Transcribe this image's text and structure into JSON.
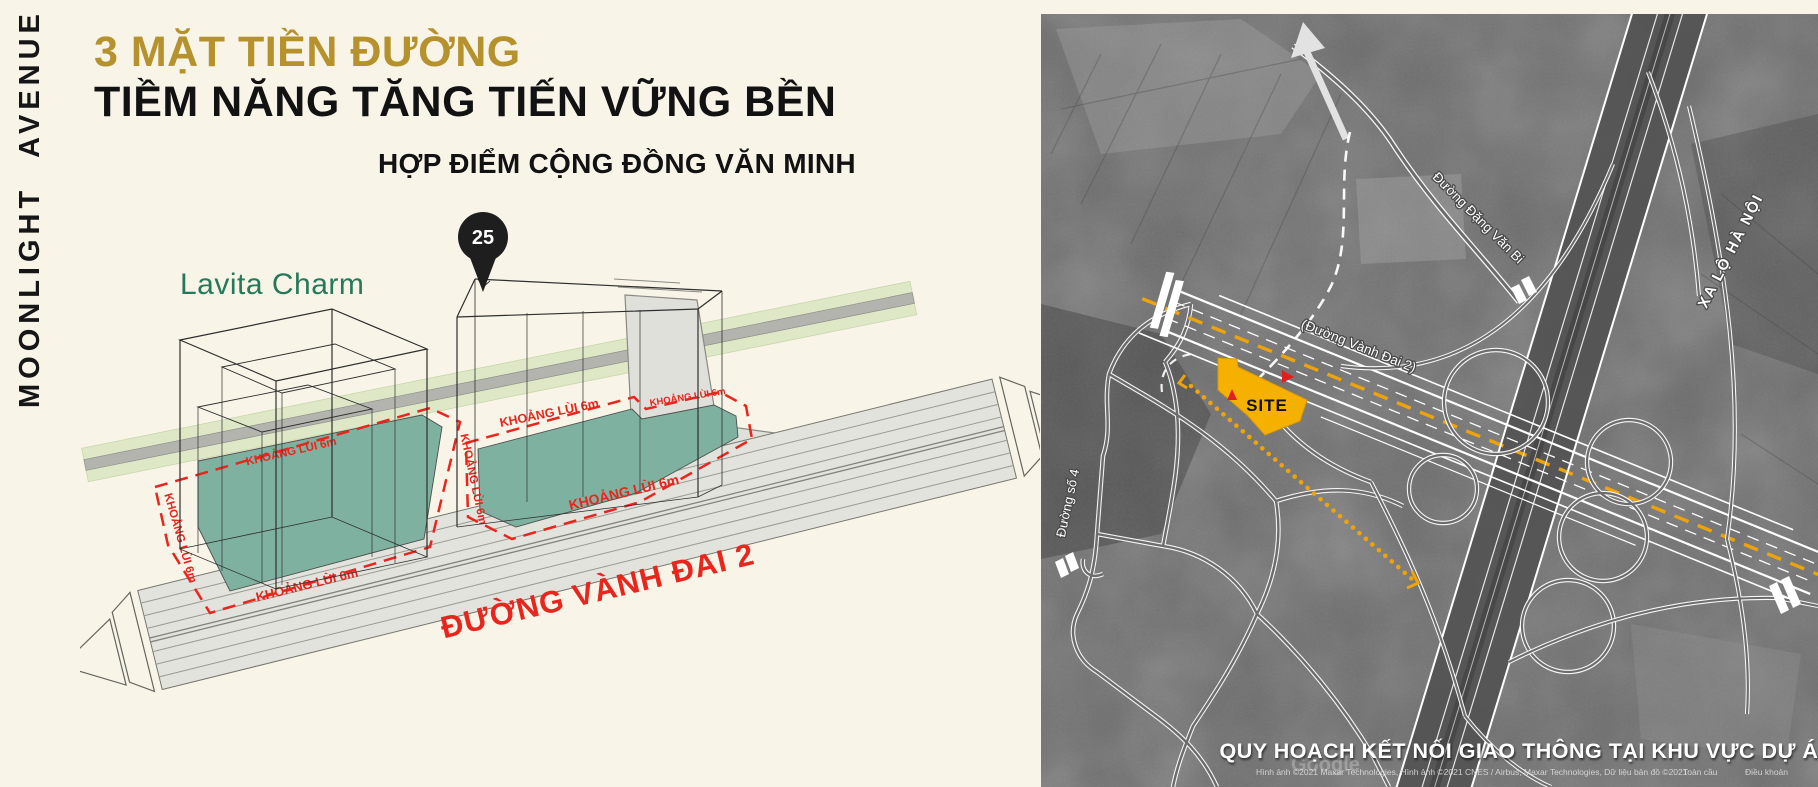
{
  "brand": {
    "vertical_title": "MOONLIGHT AVENUE"
  },
  "header": {
    "title_line1": "3 MẶT TIỀN ĐƯỜNG",
    "title_line2": "TIỀM NĂNG TĂNG TIẾN VỮNG BỀN",
    "subtitle": "HỢP ĐIỂM CỘNG ĐỒNG VĂN MINH"
  },
  "diagram": {
    "neighbor_label": "Lavita Charm",
    "pin_value": "25",
    "setback_label": "KHOẢNG LÙI 6m",
    "road_label": "ĐƯỜNG VÀNH ĐAI 2",
    "colors": {
      "setback_red": "#E8261D",
      "lot_teal": "#7FB1A0",
      "green_strip": "#DFE8C6",
      "road_gray": "#E3E3DE",
      "neighbor_green": "#26785A",
      "gold": "#B5922D"
    }
  },
  "map": {
    "site_label": "SITE",
    "labels": {
      "dang_van_bi": "Đường Đặng Văn Bi",
      "xa_lo_ha_noi": "XA LỘ HÀ NỘI",
      "vanh_dai_2": "(Đường Vành Đai 2)",
      "duong_so_4": "Đường số 4"
    },
    "caption": "QUY HOẠCH KẾT NỐI GIAO THÔNG TẠI KHU VỰC DỰ ÁN",
    "watermark": "Google",
    "attribution": {
      "credits": "Hình ảnh ©2021 Maxar Technologies, Hình ảnh ©2021 CNES / Airbus, Maxar Technologies, Dữ liệu bản đồ ©2021",
      "link1": "Toàn cầu",
      "link2": "Điều khoản"
    },
    "colors": {
      "site_yellow": "#F6B100",
      "route_yellow": "#EFA30A",
      "marker_red": "#E02020"
    }
  }
}
